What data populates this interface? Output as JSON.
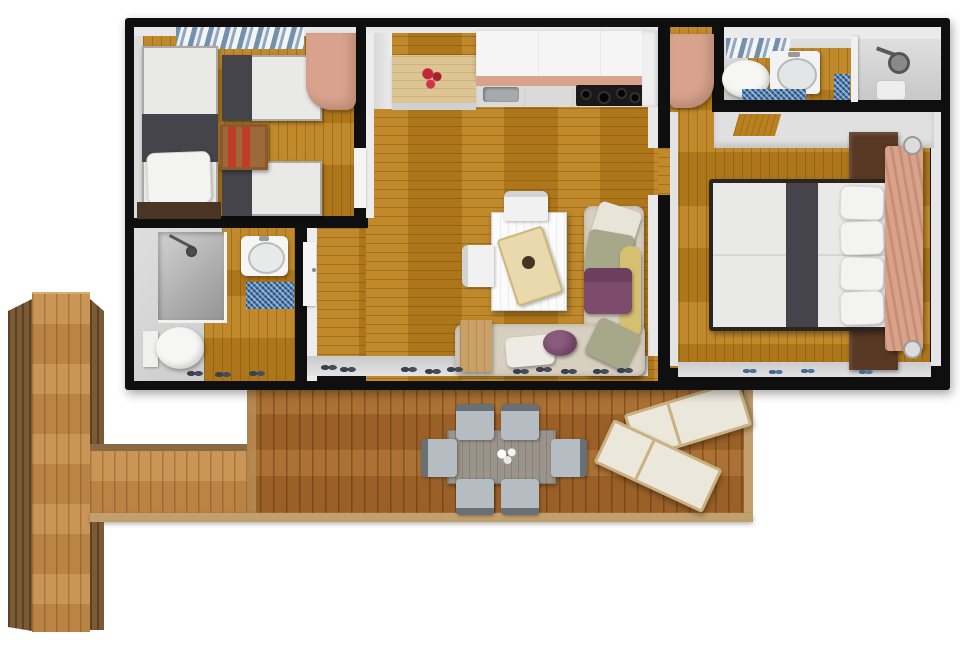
{
  "scene": {
    "kind": "3d-floor-plan-top-view-render",
    "canvas": {
      "width": 960,
      "height": 647
    },
    "background": "#ffffff"
  },
  "rooms": [
    {
      "name": "twin-bedroom",
      "furniture": [
        "single-bed-left",
        "single-bed-right-top",
        "single-bed-right-bottom",
        "red-bookshelf",
        "salmon-wardrobe",
        "window-with-blue-curtains"
      ]
    },
    {
      "name": "bathroom-left",
      "furniture": [
        "shower-cabin",
        "washbasin",
        "toilet",
        "blue-bath-mat"
      ]
    },
    {
      "name": "kitchen-living-room",
      "furniture": [
        "beech-kitchen-counter",
        "red-flowers",
        "white-wall-cabinets",
        "kitchen-sink",
        "black-cooktop",
        "white-dining-table",
        "two-white-chairs",
        "serving-tray",
        "corner-sofa",
        "cushions-sage-yellow-purple",
        "purple-pouf",
        "wooden-side-table",
        "shoes-by-window"
      ]
    },
    {
      "name": "bathroom-en-suite",
      "furniture": [
        "toilet",
        "washbasin",
        "shower-corner",
        "blue-bath-mats",
        "window-with-blue-curtains"
      ]
    },
    {
      "name": "master-bedroom",
      "furniture": [
        "double-bed",
        "salmon-headboard",
        "two-dark-nightstands",
        "wall-lamps",
        "salmon-wardrobe",
        "top-closet",
        "blue-slippers"
      ]
    },
    {
      "name": "deck-terrace",
      "furniture": [
        "grey-outdoor-table",
        "six-outdoor-chairs",
        "white-flower-centerpiece",
        "two-sun-loungers"
      ]
    },
    {
      "name": "walkway-deck",
      "furniture": []
    }
  ],
  "colors": {
    "wall": "#0f0f0f",
    "floor_wood": "#b9801f",
    "deck_wood": "#a4682c",
    "walkway_wood": "#c38c4c",
    "walkway_side": "#7b5a35",
    "deck_trim": "#c2a06e",
    "interior_wall": "#e8e8e8",
    "accent_salmon": "#d9a28c",
    "curtain_blue": "#7590ab",
    "mat_blue": "#4678ad",
    "sofa_cream": "#d7cfbf",
    "cushion_sage": "#a7a78a",
    "cushion_yellow": "#d5bf70",
    "cushion_purple": "#7d4b6c",
    "bed_runner": "#45444a",
    "bed_white": "#e9e9e7",
    "shelf_red": "#c13a2a",
    "wood_dark": "#583823",
    "table_gray": "#9a948a",
    "chair_seat": "#b6bdc2",
    "chair_back": "#697075",
    "lounger_cream": "#ebe7db",
    "lounger_frame": "#c9b183",
    "counter_beech": "#dcc493",
    "cooktop": "#191919",
    "toilet_white": "#f6f6f4",
    "shower_gray": "#b5b5b5"
  }
}
